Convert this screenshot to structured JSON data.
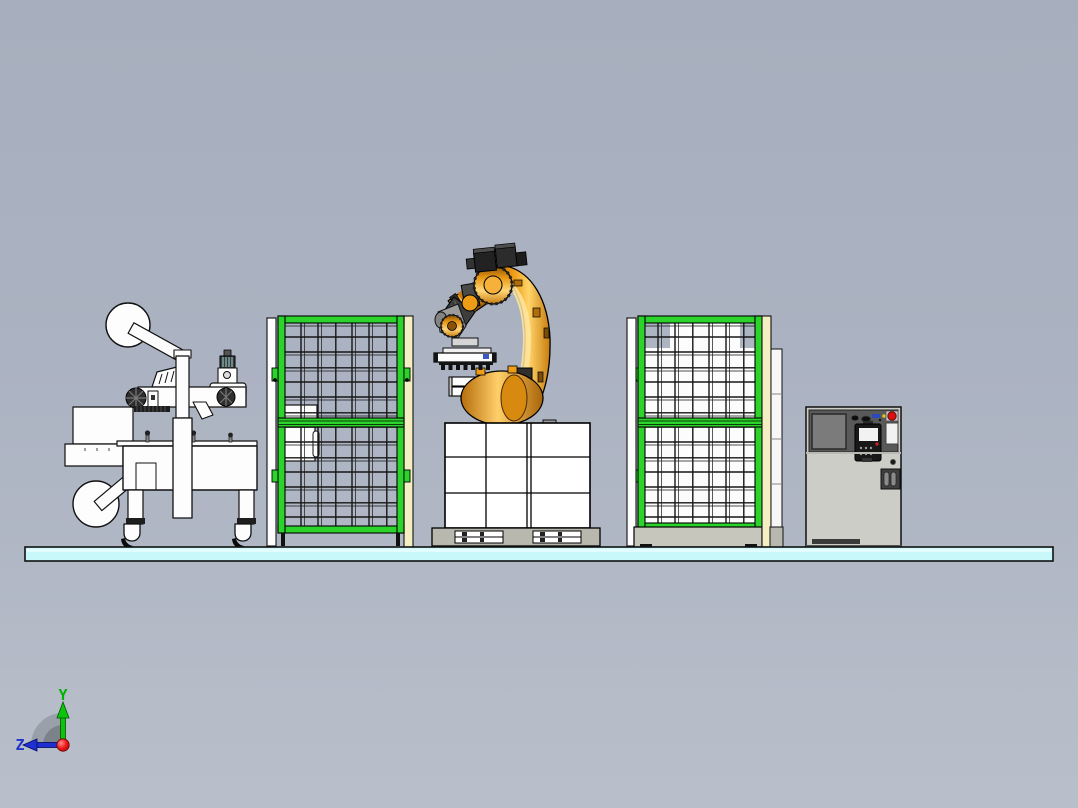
{
  "view": {
    "type": "cad-3d-viewport",
    "description": "Side elevation view of an industrial robot palletizing cell",
    "triad": {
      "y_label": "Y",
      "z_label": "Z"
    }
  },
  "colors": {
    "background_top": "#a7afbe",
    "background_bottom": "#b9bfca",
    "floor_cyan": "#c9f8fb",
    "fence_green": "#2bd32b",
    "fence_post_beige": "#f4efc2",
    "robot_orange": "#f0a11c",
    "robot_highlight": "#ffe6a0",
    "cabinet_gray": "#cdcdc7",
    "cabinet_panel_dark": "#595959",
    "estop_red": "#d91111",
    "axis_y_green": "#00b400",
    "axis_z_blue": "#2233cc",
    "origin_red": "#d40000",
    "mesh_wire": "#161616",
    "pallet_gray": "#b8b8ae"
  },
  "components": [
    {
      "name": "carton-sealing-machine",
      "label": "Carton sealing machine with two tape reels"
    },
    {
      "name": "safety-fence-left",
      "label": "Green mesh safety fence panel"
    },
    {
      "name": "palletizing-robot",
      "label": "Orange 6-axis palletizing robot with vacuum gripper"
    },
    {
      "name": "carton-stack",
      "label": "3x3 stack of cartons on pallet"
    },
    {
      "name": "safety-fence-right",
      "label": "Green mesh safety fence panel with backing"
    },
    {
      "name": "control-cabinet",
      "label": "Robot control cabinet with teach pendant"
    },
    {
      "name": "floor-platform",
      "label": "Cyan floor slab"
    },
    {
      "name": "coordinate-triad",
      "label": "View orientation triad"
    }
  ]
}
